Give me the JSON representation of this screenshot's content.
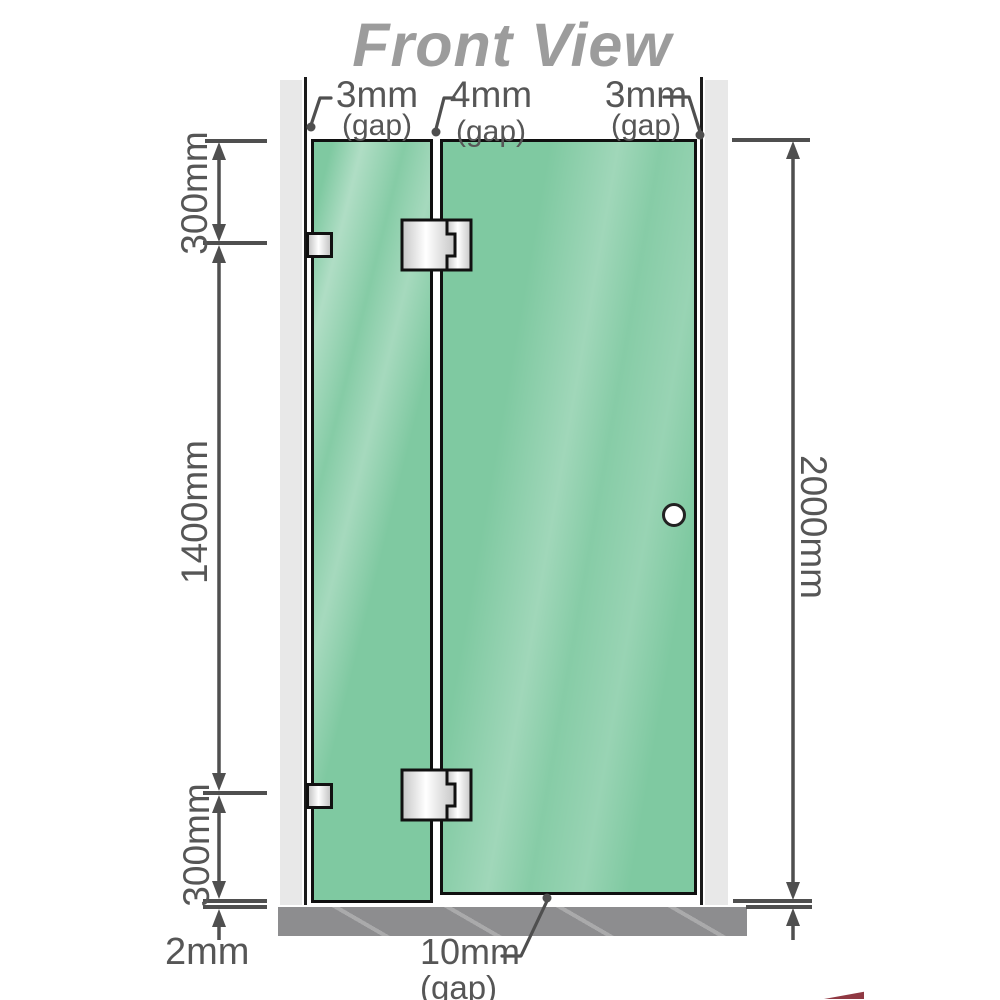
{
  "title": "Front View",
  "colors": {
    "glass": "#7fc9a1",
    "wall": "#e8e8e8",
    "channel": "#1b1b1b",
    "glass_border": "#101010",
    "base": "#8d8d8f",
    "dim": "#4f4f4f",
    "text": "#565656",
    "title_color": "#9c9c9c",
    "metal_light": "#ffffff",
    "metal_dark": "#c6c6c6",
    "hinge_outline": "#111111",
    "knob_outline": "#222222",
    "accent_red": "#7c1622"
  },
  "labels": {
    "gap_top_left": {
      "value": "3mm",
      "qualifier": "(gap)"
    },
    "gap_top_middle": {
      "value": "4mm",
      "qualifier": "(gap)"
    },
    "gap_top_right": {
      "value": "3mm",
      "qualifier": "(gap)"
    },
    "segment_top": "300mm",
    "segment_middle": "1400mm",
    "segment_bottom": "300mm",
    "overall_height": "2000mm",
    "floor_clearance": "2mm",
    "door_bottom_gap": {
      "value": "10mm",
      "qualifier": "(gap)"
    }
  }
}
